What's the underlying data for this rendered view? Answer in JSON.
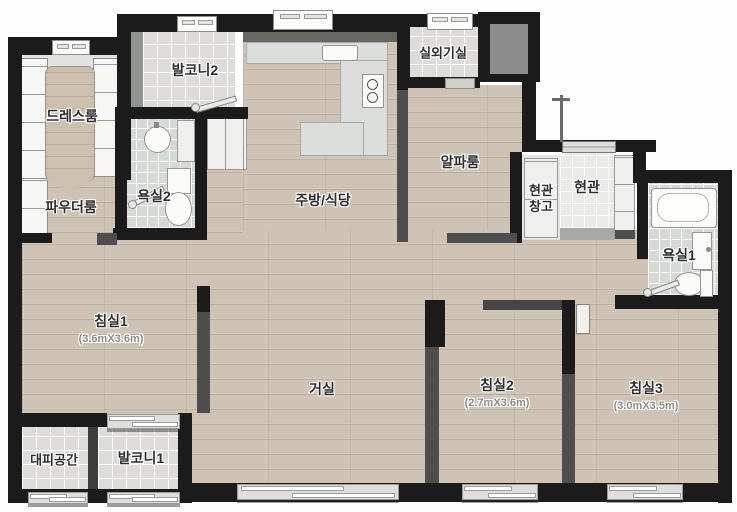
{
  "plan": {
    "rooms": {
      "dress_room": {
        "label": "드레스룸"
      },
      "balcony2": {
        "label": "발코니2"
      },
      "bathroom2": {
        "label": "욕실2"
      },
      "powder_room": {
        "label": "파우더룸"
      },
      "kitchen_dining": {
        "label": "주방/식당"
      },
      "outdoor_unit_room": {
        "label": "실외기실"
      },
      "alpha_room": {
        "label": "알파룸"
      },
      "entrance_storage": {
        "label": "현관창고"
      },
      "entrance": {
        "label": "현관"
      },
      "bathroom1": {
        "label": "욕실1"
      },
      "bedroom1": {
        "label": "침실1",
        "dim": "(3.6mX3.6m)"
      },
      "living_room": {
        "label": "거실"
      },
      "bedroom2": {
        "label": "침실2",
        "dim": "(2.7mX3.6m)"
      },
      "bedroom3": {
        "label": "침실3",
        "dim": "(3.0mX3.5m)"
      },
      "escape_space": {
        "label": "대피공간"
      },
      "balcony1": {
        "label": "발코니1"
      }
    },
    "palette": {
      "exterior_wall": "#1b1b1b",
      "interior_wall": "#4e4e4e",
      "wood_floor": "#cec3b5",
      "tile_floor": "#dddcd9",
      "bath_tile": "#d6dad7"
    }
  }
}
